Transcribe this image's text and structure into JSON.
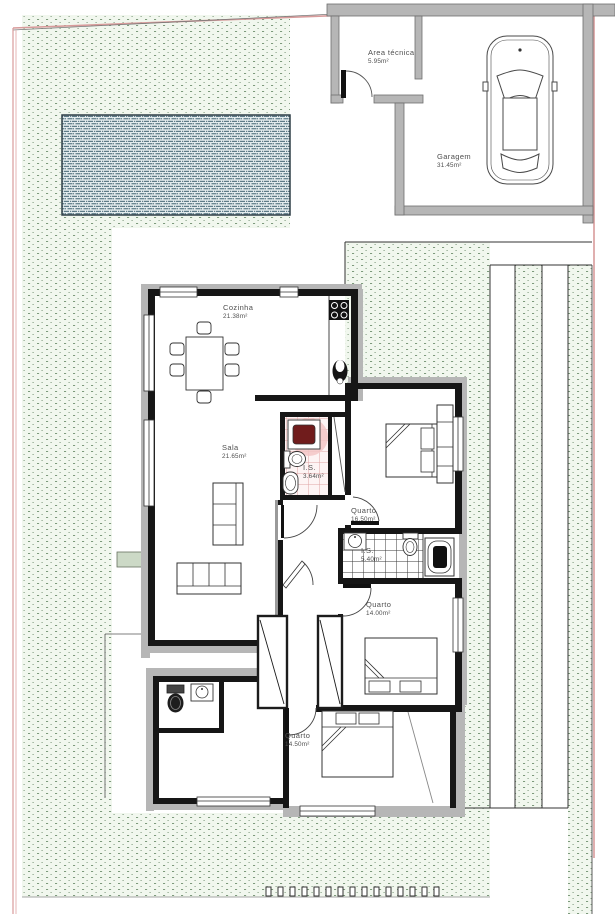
{
  "title": "Floor plan",
  "site": {
    "boundary_color": "#d89b9b",
    "lawn_dot_color": "#7d9a7c",
    "pool_color": "#4f6f7d",
    "wall_color": "#b6b6b6",
    "bath_tile_pink": "#dfa3a3",
    "shower_mat_color": "#701c1c"
  },
  "rooms": [
    {
      "id": "area-tecnica",
      "name": "Area técnica",
      "area": "5.95m²"
    },
    {
      "id": "garagem",
      "name": "Garagem",
      "area": "31.45m²"
    },
    {
      "id": "cozinha",
      "name": "Cozinha",
      "area": "21.38m²"
    },
    {
      "id": "sala",
      "name": "Sala",
      "area": "21.65m²"
    },
    {
      "id": "is-1",
      "name": "I.S.",
      "area": "3.64m²"
    },
    {
      "id": "quarto-1",
      "name": "Quarto",
      "area": "16.50m²"
    },
    {
      "id": "is-2",
      "name": "I.S.",
      "area": "5.40m²"
    },
    {
      "id": "quarto-2",
      "name": "Quarto",
      "area": "14.00m²"
    },
    {
      "id": "quarto-3",
      "name": "Quarto",
      "area": "14.50m²"
    }
  ]
}
